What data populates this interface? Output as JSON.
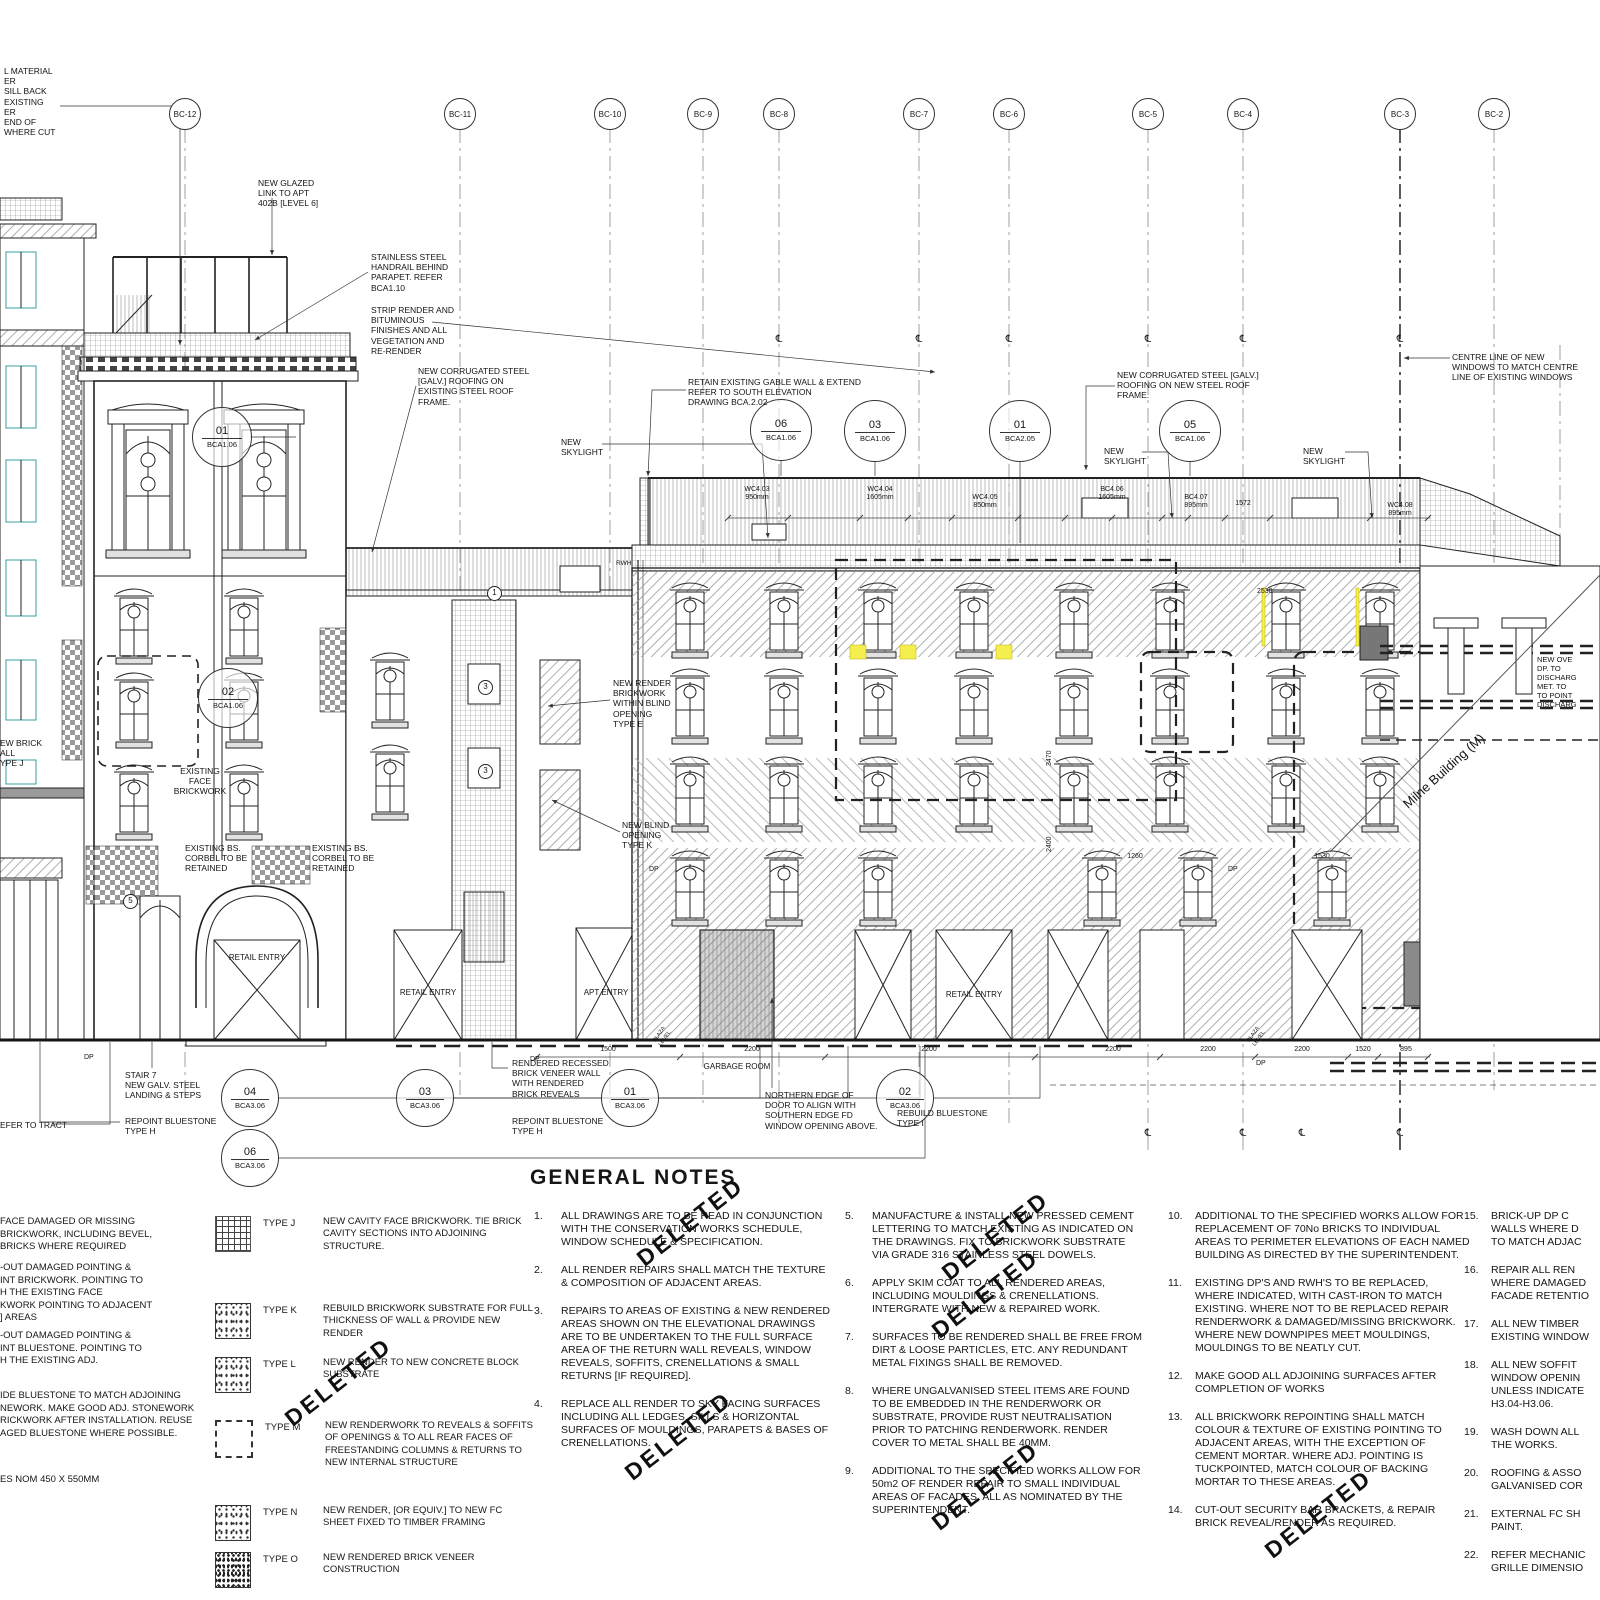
{
  "colors": {
    "paper": "#ffffff",
    "ink": "#1c1c1c",
    "teal": "#3aa0a0",
    "highlight": "#f4ee4e",
    "grey": "#888888"
  },
  "grid": {
    "bubbles": [
      {
        "label": "BC-12",
        "x": 185
      },
      {
        "label": "BC-11",
        "x": 460
      },
      {
        "label": "BC-10",
        "x": 610
      },
      {
        "label": "BC-9",
        "x": 703
      },
      {
        "label": "BC-8",
        "x": 779
      },
      {
        "label": "BC-7",
        "x": 919
      },
      {
        "label": "BC-6",
        "x": 1009
      },
      {
        "label": "BC-5",
        "x": 1148
      },
      {
        "label": "BC-4",
        "x": 1243
      },
      {
        "label": "BC-3",
        "x": 1400
      },
      {
        "label": "BC-2",
        "x": 1494
      }
    ]
  },
  "callouts": [
    {
      "num": "01",
      "sheet": "BCA1.06",
      "x": 222,
      "y": 437,
      "d": 58
    },
    {
      "num": "02",
      "sheet": "BCA1.06",
      "x": 228,
      "y": 698,
      "d": 58
    },
    {
      "num": "06",
      "sheet": "BCA1.06",
      "x": 781,
      "y": 430,
      "d": 60
    },
    {
      "num": "03",
      "sheet": "BCA1.06",
      "x": 875,
      "y": 431,
      "d": 60
    },
    {
      "num": "01",
      "sheet": "BCA2.05",
      "x": 1020,
      "y": 431,
      "d": 60
    },
    {
      "num": "05",
      "sheet": "BCA1.06",
      "x": 1190,
      "y": 431,
      "d": 60
    },
    {
      "num": "04",
      "sheet": "BCA3.06",
      "x": 250,
      "y": 1098,
      "d": 56
    },
    {
      "num": "06",
      "sheet": "BCA3.06",
      "x": 250,
      "y": 1158,
      "d": 56
    },
    {
      "num": "03",
      "sheet": "BCA3.06",
      "x": 425,
      "y": 1098,
      "d": 56
    },
    {
      "num": "01",
      "sheet": "BCA3.06",
      "x": 630,
      "y": 1098,
      "d": 56
    },
    {
      "num": "02",
      "sheet": "BCA3.06",
      "x": 905,
      "y": 1098,
      "d": 56
    }
  ],
  "labels": [
    {
      "t": "L MATERIAL\nER\nSILL BACK\nEXISTING\nER\nEND OF\nWHERE CUT",
      "x": 4,
      "y": 66
    },
    {
      "t": "NEW GLAZED\nLINK TO APT\n402B [LEVEL 6]",
      "x": 258,
      "y": 178
    },
    {
      "t": "STAINLESS STEEL\nHANDRAIL BEHIND\nPARAPET. REFER\nBCA1.10",
      "x": 371,
      "y": 252
    },
    {
      "t": "STRIP RENDER AND\nBITUMINOUS\nFINISHES AND ALL\nVEGETATION AND\nRE-RENDER",
      "x": 371,
      "y": 305
    },
    {
      "t": "NEW CORRUGATED STEEL\n[GALV.] ROOFING ON\nEXISTING STEEL ROOF\nFRAME.",
      "x": 418,
      "y": 366
    },
    {
      "t": "NEW\nSKYLIGHT",
      "x": 561,
      "y": 437
    },
    {
      "t": "RETAIN EXISTING GABLE WALL & EXTEND\nREFER TO SOUTH ELEVATION\nDRAWING BCA.2.02",
      "x": 688,
      "y": 377
    },
    {
      "t": "NEW CORRUGATED STEEL [GALV.]\nROOFING ON NEW STEEL ROOF\nFRAME.",
      "x": 1117,
      "y": 370
    },
    {
      "t": "NEW\nSKYLIGHT",
      "x": 1104,
      "y": 446
    },
    {
      "t": "NEW\nSKYLIGHT",
      "x": 1303,
      "y": 446
    },
    {
      "t": "CENTRE LINE OF NEW\nWINDOWS TO MATCH CENTRE\nLINE OF EXISTING WINDOWS",
      "x": 1452,
      "y": 352
    },
    {
      "t": "NEW RENDER\nBRICKWORK\nWITHIN BLIND\nOPENING\nTYPE E",
      "x": 613,
      "y": 678
    },
    {
      "t": "NEW BLIND\nOPENING\nTYPE K",
      "x": 622,
      "y": 820
    },
    {
      "t": "EXISTING\nFACE\nBRICKWORK",
      "x": 200,
      "y": 766,
      "cls": "ctr"
    },
    {
      "t": "EXISTING BS.\nCORBEL TO BE\nRETAINED",
      "x": 185,
      "y": 843
    },
    {
      "t": "EXISTING BS.\nCORBEL TO BE\nRETAINED",
      "x": 312,
      "y": 843
    },
    {
      "t": "EW BRICK\nALL\nYPE J",
      "x": 0,
      "y": 738
    },
    {
      "t": "RETAIL ENTRY",
      "x": 257,
      "y": 953,
      "fs": 8,
      "cls": "ctr"
    },
    {
      "t": "RETAIL ENTRY",
      "x": 428,
      "y": 988,
      "fs": 8,
      "cls": "ctr"
    },
    {
      "t": "RETAIL ENTRY",
      "x": 974,
      "y": 990,
      "fs": 8,
      "cls": "ctr"
    },
    {
      "t": "APT ENTRY",
      "x": 606,
      "y": 988,
      "fs": 8,
      "cls": "ctr"
    },
    {
      "t": "GARBAGE ROOM",
      "x": 737,
      "y": 1062,
      "fs": 8,
      "cls": "ctr"
    },
    {
      "t": "STAIR 7\nNEW GALV. STEEL\nLANDING & STEPS",
      "x": 125,
      "y": 1070
    },
    {
      "t": "REPOINT BLUESTONE\nTYPE H",
      "x": 125,
      "y": 1116
    },
    {
      "t": "REPOINT BLUESTONE\nTYPE H",
      "x": 512,
      "y": 1116
    },
    {
      "t": "RENDERED RECESSED\nBRICK VENEER WALL\nWITH RENDERED\nBRICK REVEALS",
      "x": 512,
      "y": 1058
    },
    {
      "t": "NORTHERN EDGE OF\nDOOR TO ALIGN WITH\nSOUTHERN EDGE FD\nWINDOW OPENING ABOVE.",
      "x": 765,
      "y": 1090
    },
    {
      "t": "REBUILD BLUESTONE\nTYPE I",
      "x": 897,
      "y": 1108
    },
    {
      "t": "EFER TO TRACT",
      "x": 0,
      "y": 1120
    },
    {
      "t": "NEW OVE\nDP. TO\nDISCHARG\nMET. TO\nTO POINT\nDISCHARG",
      "x": 1537,
      "y": 655,
      "fs": 7.5
    },
    {
      "t": "Milne Building (M)",
      "x": 1400,
      "y": 800,
      "rot": -42,
      "fs": 13
    },
    {
      "t": "RWH",
      "x": 616,
      "y": 560,
      "fs": 6.5
    },
    {
      "t": "DP",
      "x": 649,
      "y": 866,
      "fs": 7
    },
    {
      "t": "DP",
      "x": 1228,
      "y": 866,
      "fs": 7
    },
    {
      "t": "DP",
      "x": 84,
      "y": 1054,
      "fs": 7
    },
    {
      "t": "DP",
      "x": 530,
      "y": 1056,
      "fs": 7
    },
    {
      "t": "DP",
      "x": 1256,
      "y": 1060,
      "fs": 7
    },
    {
      "t": "WC4.03\n950mm",
      "x": 757,
      "y": 486,
      "fs": 7,
      "cls": "ctr"
    },
    {
      "t": "WC4.04\n1605mm",
      "x": 880,
      "y": 486,
      "fs": 7,
      "cls": "ctr"
    },
    {
      "t": "WC4.05\n850mm",
      "x": 985,
      "y": 494,
      "fs": 7,
      "cls": "ctr"
    },
    {
      "t": "BC4.06\n1605mm",
      "x": 1112,
      "y": 486,
      "fs": 7,
      "cls": "ctr"
    },
    {
      "t": "BC4.07\n895mm",
      "x": 1196,
      "y": 494,
      "fs": 7,
      "cls": "ctr"
    },
    {
      "t": "1572",
      "x": 1243,
      "y": 500,
      "fs": 7,
      "cls": "ctr"
    },
    {
      "t": "WC4.08\n895mm",
      "x": 1400,
      "y": 502,
      "fs": 7,
      "cls": "ctr"
    },
    {
      "t": "3470",
      "x": 1046,
      "y": 766,
      "rot": -90,
      "fs": 7
    },
    {
      "t": "2400",
      "x": 1046,
      "y": 852,
      "rot": -90,
      "fs": 7
    },
    {
      "t": "1260",
      "x": 1135,
      "y": 853,
      "fs": 7,
      "cls": "ctr"
    },
    {
      "t": "1530",
      "x": 1322,
      "y": 853,
      "fs": 7,
      "cls": "ctr"
    },
    {
      "t": "2530",
      "x": 1257,
      "y": 588,
      "fs": 7
    },
    {
      "t": "1500",
      "x": 608,
      "y": 1046,
      "fs": 7,
      "cls": "ctr"
    },
    {
      "t": "2200",
      "x": 752,
      "y": 1046,
      "fs": 7,
      "cls": "ctr"
    },
    {
      "t": "2200",
      "x": 929,
      "y": 1046,
      "fs": 7,
      "cls": "ctr"
    },
    {
      "t": "2200",
      "x": 1113,
      "y": 1046,
      "fs": 7,
      "cls": "ctr"
    },
    {
      "t": "2200",
      "x": 1208,
      "y": 1046,
      "fs": 7,
      "cls": "ctr"
    },
    {
      "t": "2200",
      "x": 1302,
      "y": 1046,
      "fs": 7,
      "cls": "ctr"
    },
    {
      "t": "1520",
      "x": 1363,
      "y": 1046,
      "fs": 7,
      "cls": "ctr"
    },
    {
      "t": "895",
      "x": 1406,
      "y": 1046,
      "fs": 7,
      "cls": "ctr"
    },
    {
      "t": "PLAZA\nLEVEL",
      "x": 652,
      "y": 1040,
      "rot": -55,
      "fs": 5.5
    },
    {
      "t": "PLAZA\nLEVEL",
      "x": 1246,
      "y": 1040,
      "rot": -55,
      "fs": 5.5
    },
    {
      "t": "℄",
      "x": 779,
      "y": 334,
      "fs": 10,
      "cls": "ctr"
    },
    {
      "t": "℄",
      "x": 919,
      "y": 334,
      "fs": 10,
      "cls": "ctr"
    },
    {
      "t": "℄",
      "x": 1009,
      "y": 334,
      "fs": 10,
      "cls": "ctr"
    },
    {
      "t": "℄",
      "x": 1148,
      "y": 334,
      "fs": 10,
      "cls": "ctr"
    },
    {
      "t": "℄",
      "x": 1243,
      "y": 334,
      "fs": 10,
      "cls": "ctr"
    },
    {
      "t": "℄",
      "x": 1400,
      "y": 334,
      "fs": 10,
      "cls": "ctr"
    },
    {
      "t": "℄",
      "x": 1148,
      "y": 1128,
      "fs": 10,
      "cls": "ctr"
    },
    {
      "t": "℄",
      "x": 1243,
      "y": 1128,
      "fs": 10,
      "cls": "ctr"
    },
    {
      "t": "℄",
      "x": 1302,
      "y": 1128,
      "fs": 10,
      "cls": "ctr"
    },
    {
      "t": "℄",
      "x": 1400,
      "y": 1128,
      "fs": 10,
      "cls": "ctr"
    },
    {
      "t": "1",
      "x": 487,
      "y": 586,
      "cls": "circ"
    },
    {
      "t": "3",
      "x": 478,
      "y": 680,
      "cls": "circ"
    },
    {
      "t": "3",
      "x": 478,
      "y": 764,
      "cls": "circ"
    },
    {
      "t": "5",
      "x": 123,
      "y": 894,
      "cls": "circ"
    }
  ],
  "stamps": [
    {
      "t": "DELETED",
      "x": 640,
      "y": 1248,
      "rot": -38
    },
    {
      "t": "DELETED",
      "x": 628,
      "y": 1462,
      "rot": -38
    },
    {
      "t": "DELETED",
      "x": 945,
      "y": 1262,
      "rot": -38
    },
    {
      "t": "DELETED",
      "x": 935,
      "y": 1320,
      "rot": -38
    },
    {
      "t": "DELETED",
      "x": 935,
      "y": 1512,
      "rot": -38
    },
    {
      "t": "DELETED",
      "x": 1268,
      "y": 1540,
      "rot": -38
    },
    {
      "t": "DELETED",
      "x": 288,
      "y": 1408,
      "rot": -38
    }
  ],
  "notes": {
    "title": "GENERAL NOTES",
    "left_blocks": [
      {
        "t": "FACE DAMAGED OR MISSING\nBRICKWORK, INCLUDING BEVEL,\nBRICKS WHERE REQUIRED",
        "x": 0,
        "y": 1216
      },
      {
        "t": "-OUT DAMAGED POINTING &\nINT BRICKWORK. POINTING TO\nH THE EXISTING FACE\nKWORK POINTING TO ADJACENT\n] AREAS",
        "x": 0,
        "y": 1262
      },
      {
        "t": "-OUT DAMAGED POINTING &\nINT BLUESTONE. POINTING TO\nH THE EXISTING ADJ.",
        "x": 0,
        "y": 1330
      },
      {
        "t": "IDE BLUESTONE TO MATCH ADJOINING\nNEWORK. MAKE GOOD ADJ. STONEWORK\nRICKWORK AFTER INSTALLATION. REUSE\nAGED BLUESTONE WHERE POSSIBLE.",
        "x": 0,
        "y": 1390
      },
      {
        "t": "ES NOM 450 X 550MM",
        "x": 0,
        "y": 1474
      }
    ],
    "col1": [
      {
        "num": "1.",
        "text": "ALL DRAWINGS ARE TO BE READ IN CONJUNCTION WITH THE CONSERVATION WORKS SCHEDULE, WINDOW SCHEDULE & SPECIFICATION."
      },
      {
        "num": "2.",
        "text": "ALL RENDER REPAIRS SHALL MATCH THE TEXTURE & COMPOSITION OF ADJACENT AREAS."
      },
      {
        "num": "3.",
        "text": "REPAIRS TO AREAS OF EXISTING & NEW RENDERED AREAS SHOWN ON THE ELEVATIONAL DRAWINGS ARE TO BE UNDERTAKEN TO THE FULL SURFACE AREA OF THE RETURN WALL REVEALS, WINDOW REVEALS, SOFFITS, CRENELLATIONS & SMALL RETURNS [IF REQUIRED]."
      },
      {
        "num": "4.",
        "text": "REPLACE ALL RENDER TO SKY FACING SURFACES INCLUDING ALL LEDGES, SILLS & HORIZONTAL SURFACES OF MOULDINGS, PARAPETS & BASES OF CRENELLATIONS."
      }
    ],
    "col2": [
      {
        "num": "5.",
        "text": "MANUFACTURE & INSTALL NEW PRESSED CEMENT LETTERING TO MATCH EXISTING AS INDICATED ON THE DRAWINGS. FIX TO BRICKWORK SUBSTRATE VIA GRADE 316 STAINLESS STEEL DOWELS."
      },
      {
        "num": "6.",
        "text": "APPLY SKIM COAT TO ALL RENDERED AREAS, INCLUDING MOULDINGS & CRENELLATIONS. INTERGRATE WITH NEW & REPAIRED WORK."
      },
      {
        "num": "7.",
        "text": "SURFACES TO BE RENDERED SHALL BE FREE FROM DIRT & LOOSE PARTICLES, ETC. ANY REDUNDANT METAL FIXINGS SHALL BE REMOVED."
      },
      {
        "num": "8.",
        "text": "WHERE UNGALVANISED STEEL ITEMS ARE FOUND TO BE EMBEDDED IN THE RENDERWORK OR SUBSTRATE, PROVIDE RUST NEUTRALISATION PRIOR TO PATCHING RENDERWORK. RENDER COVER TO METAL SHALL BE 40MM."
      },
      {
        "num": "9.",
        "text": "ADDITIONAL TO THE SPECIFIED WORKS ALLOW FOR 50m2 OF RENDER REPAIR TO SMALL INDIVIDUAL AREAS OF FACADES, ALL AS NOMINATED BY THE SUPERINTENDENT."
      }
    ],
    "col3": [
      {
        "num": "10.",
        "text": "ADDITIONAL TO THE SPECIFIED WORKS ALLOW FOR REPLACEMENT OF 70No BRICKS TO INDIVIDUAL AREAS TO PERIMETER ELEVATIONS OF EACH NAMED BUILDING AS DIRECTED BY THE SUPERINTENDENT."
      },
      {
        "num": "11.",
        "text": "EXISTING DP'S AND RWH'S TO BE REPLACED, WHERE INDICATED, WITH CAST-IRON TO MATCH EXISTING. WHERE NOT TO BE REPLACED REPAIR RENDERWORK & DAMAGED/MISSING BRICKWORK. WHERE NEW DOWNPIPES MEET MOULDINGS, MOULDINGS TO BE NEATLY CUT."
      },
      {
        "num": "12.",
        "text": "MAKE GOOD ALL ADJOINING SURFACES AFTER COMPLETION OF WORKS"
      },
      {
        "num": "13.",
        "text": "ALL BRICKWORK REPOINTING SHALL MATCH COLOUR & TEXTURE OF EXISTING POINTING TO ADJACENT AREAS, WITH THE EXCEPTION OF CEMENT MORTAR. WHERE ADJ. POINTING IS TUCKPOINTED, MATCH COLOUR OF BACKING MORTAR TO THESE AREAS."
      },
      {
        "num": "14.",
        "text": "CUT-OUT SECURITY BAR BRACKETS, & REPAIR BRICK REVEAL/RENDER AS REQUIRED."
      }
    ],
    "col4": [
      {
        "num": "15.",
        "text": "BRICK-UP DP C\nWALLS WHERE D\nTO MATCH ADJAC"
      },
      {
        "num": "16.",
        "text": "REPAIR ALL REN\nWHERE DAMAGED\nFACADE RETENTIO"
      },
      {
        "num": "17.",
        "text": "ALL NEW TIMBER\nEXISTING WINDOW"
      },
      {
        "num": "18.",
        "text": "ALL NEW SOFFIT\nWINDOW OPENIN\nUNLESS INDICATE\nH3.04-H3.06."
      },
      {
        "num": "19.",
        "text": "WASH DOWN ALL\nTHE WORKS."
      },
      {
        "num": "20.",
        "text": "ROOFING & ASSO\nGALVANISED COR"
      },
      {
        "num": "21.",
        "text": "EXTERNAL FC SH\nPAINT."
      },
      {
        "num": "22.",
        "text": "REFER MECHANIC\nGRILLE DIMENSIO"
      }
    ]
  },
  "legend": [
    {
      "type": "TYPE J",
      "sw": "sw-brick",
      "y": 1216,
      "text": "NEW CAVITY FACE BRICKWORK. TIE BRICK CAVITY SECTIONS INTO ADJOINING STRUCTURE."
    },
    {
      "type": "TYPE K",
      "sw": "sw-speck",
      "y": 1303,
      "text": "REBUILD BRICKWORK SUBSTRATE FOR FULL THICKNESS OF WALL & PROVIDE NEW RENDER"
    },
    {
      "type": "TYPE L",
      "sw": "sw-speck",
      "y": 1357,
      "text": "NEW RENDER TO NEW CONCRETE BLOCK SUBSTRATE"
    },
    {
      "type": "TYPE M",
      "sw": "sw-dash",
      "y": 1420,
      "text": "NEW RENDERWORK TO REVEALS & SOFFITS OF OPENINGS & TO ALL REAR FACES OF FREESTANDING COLUMNS & RETURNS TO NEW INTERNAL STRUCTURE"
    },
    {
      "type": "TYPE N",
      "sw": "sw-speck",
      "y": 1505,
      "text": "NEW RENDER, [OR EQUIV.] TO NEW FC SHEET FIXED TO TIMBER FRAMING"
    },
    {
      "type": "TYPE O",
      "sw": "sw-dense",
      "y": 1552,
      "text": "NEW RENDERED BRICK VENEER CONSTRUCTION"
    }
  ]
}
